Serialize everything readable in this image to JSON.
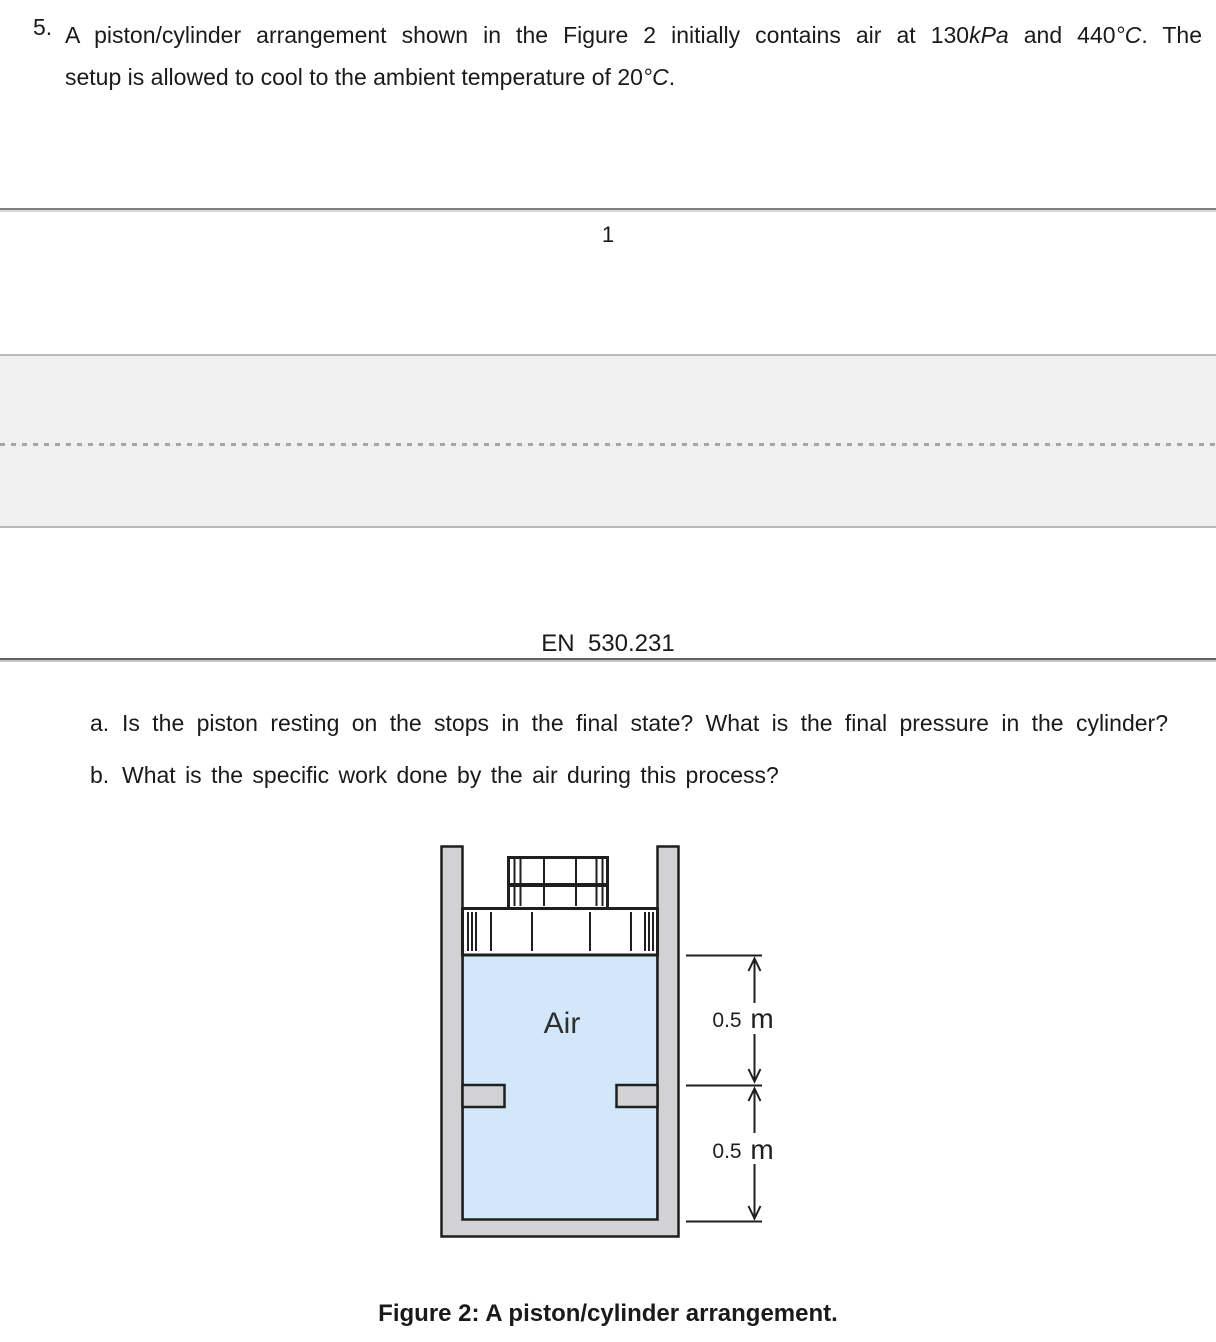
{
  "document": {
    "problem": {
      "marker": "5.",
      "line1": {
        "s0": "A piston/cylinder arrangement shown in the Figure 2 initially contains air at ",
        "s1": "130",
        "s2": "kPa",
        "s3": " and ",
        "s4": "440",
        "s5": "°C",
        "s6": ". The"
      },
      "line2": {
        "s0": "setup is allowed to cool to the ambient temperature of ",
        "s1": "20",
        "s2": "°C",
        "s3": "."
      }
    },
    "page_number": "1",
    "course_header": "EN  530.231",
    "questions": {
      "a": {
        "marker": "a.",
        "text": "Is the piston resting on the stops in the final state? What is the final pressure in the cylinder?"
      },
      "b": {
        "marker": "b.",
        "text": "What is the specific work done by the air during this process?"
      }
    },
    "figure": {
      "air_label": "Air",
      "dim_top_value": "0.5",
      "dim_top_unit": "m",
      "dim_bottom_value": "0.5",
      "dim_bottom_unit": "m",
      "caption": "Figure 2: A piston/cylinder arrangement.",
      "colors": {
        "air_fill": "#d2e8fa",
        "metal_fill": "#d2d2d5",
        "line": "#1f1f1f"
      }
    }
  }
}
